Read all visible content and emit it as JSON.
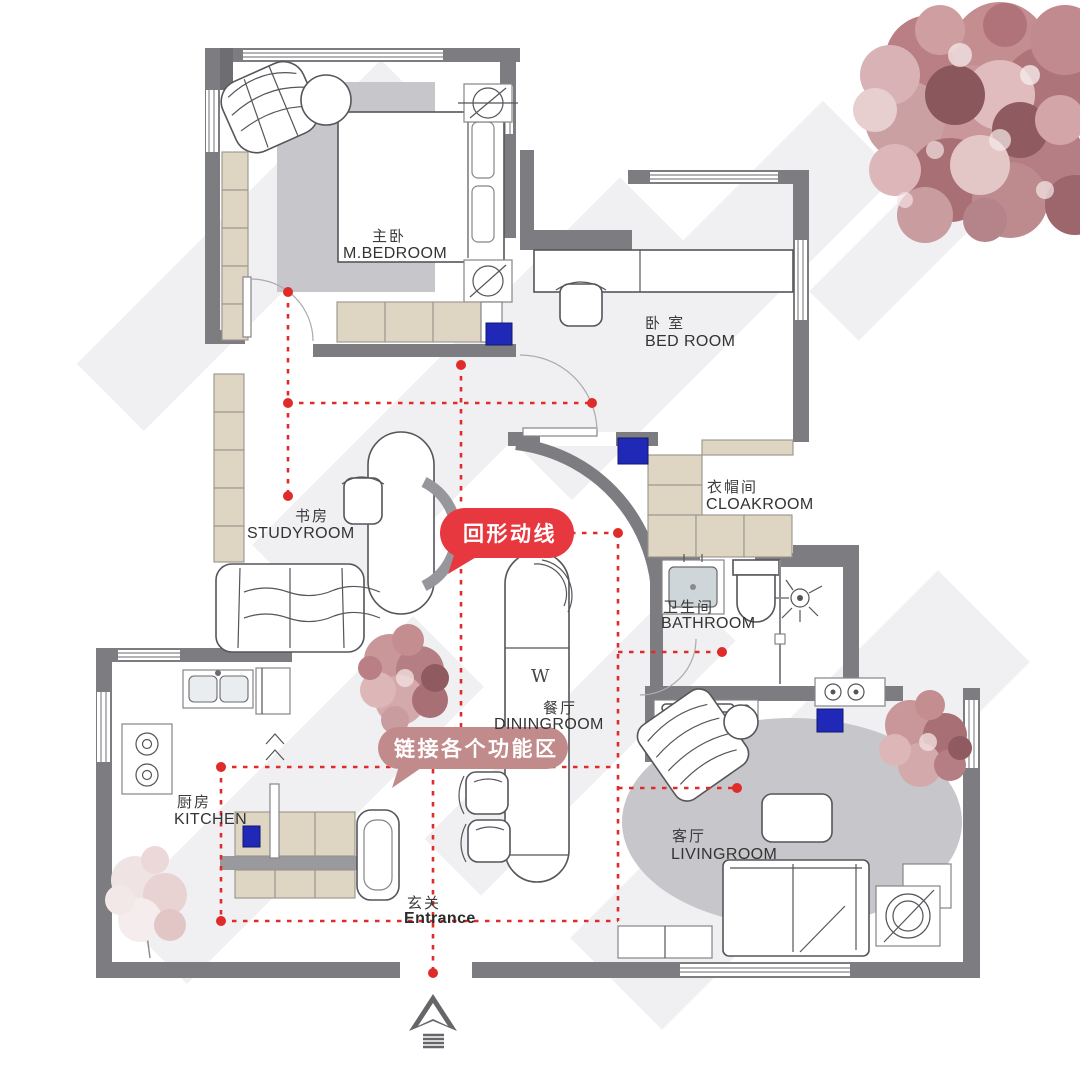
{
  "title": "apartment-floor-plan",
  "colors": {
    "accent_red": "#e8383f",
    "rose": "#c28b8b",
    "path_red": "#e02b2b",
    "wall_gray": "#7d7d81",
    "furniture_beige": "#ded5c2",
    "marker_blue": "#2028b8",
    "rug_gray": "#c7c7cb",
    "tree_pink": "#c9969a"
  },
  "rooms": {
    "mbedroom": {
      "zh": "主卧",
      "en": "M.BEDROOM"
    },
    "bedroom": {
      "zh": "卧 室",
      "en": "BED ROOM"
    },
    "study": {
      "zh": "书房",
      "en": "STUDYROOM"
    },
    "cloakroom": {
      "zh": "衣帽间",
      "en": "CLOAKROOM"
    },
    "bathroom": {
      "zh": "卫生间",
      "en": "BATHROOM"
    },
    "dining": {
      "zh": "餐厅",
      "en": "DININGROOM"
    },
    "kitchen": {
      "zh": "厨房",
      "en": "KITCHEN"
    },
    "living": {
      "zh": "客厅",
      "en": "LIVINGROOM"
    },
    "entrance": {
      "zh": "玄关",
      "en": "Entrance"
    }
  },
  "callouts": {
    "loop": "回形动线",
    "link": "链接各个功能区"
  },
  "labels": {
    "dining_table_letter": "W"
  }
}
